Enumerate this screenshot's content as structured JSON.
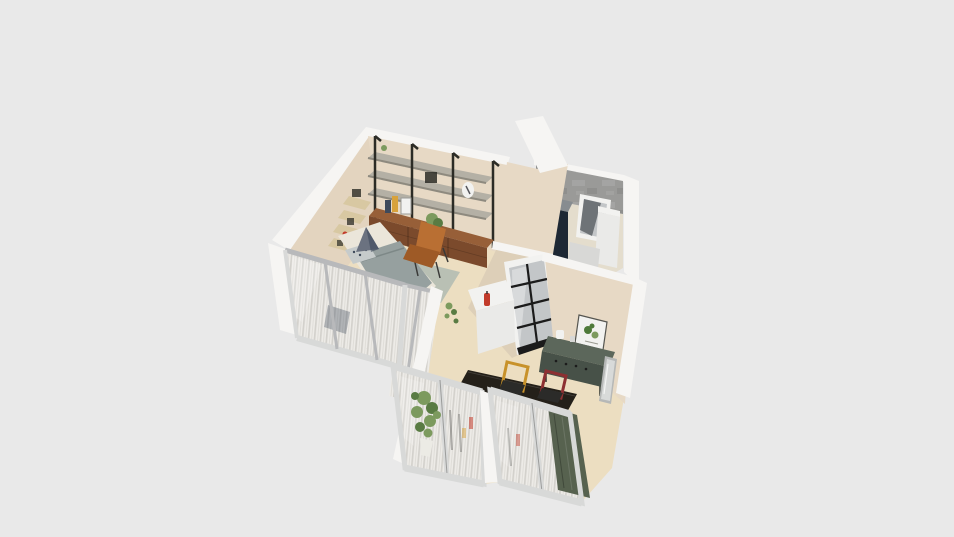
{
  "scene": {
    "type": "3d-floorplan-render",
    "view": "isometric-top-down",
    "visible_text": "",
    "rooms": [
      {
        "name": "bedroom",
        "items": [
          "bed",
          "gray-duvet",
          "triangle-headboard-cushion",
          "patterned-pillow",
          "corner-wall-shelves",
          "gray-green-rug",
          "glass-partition-sheer-curtains"
        ]
      },
      {
        "name": "living-area",
        "items": [
          "wall-shelving-unit-3-bays",
          "walnut-base-cabinets",
          "yellow-vase",
          "picture-frames",
          "potted-plants",
          "tan-leather-chair",
          "white-counter",
          "red-extinguisher",
          "floor-plant-sprig"
        ]
      },
      {
        "name": "kitchen",
        "items": [
          "concrete-accent-wall",
          "navy-refrigerator",
          "window",
          "white-tall-cabinet",
          "white-counter",
          "glazed-black-grid-door"
        ]
      },
      {
        "name": "dining-area",
        "items": [
          "dark-dining-table",
          "yellow-frame-chair",
          "red-frame-chair",
          "green-sideboard",
          "white-kettle",
          "botanical-wall-art",
          "leaning-floor-mirror"
        ]
      },
      {
        "name": "balcony-front",
        "items": [
          "sliding-glass-door-left",
          "sliding-glass-door-right",
          "sheer-curtains",
          "dark-green-curtain",
          "tall-potted-plant"
        ]
      }
    ]
  },
  "colors": {
    "background": "#e9e9e9",
    "wall_white": "#f6f5f3",
    "wall_beige": "#e7d9c5",
    "wall_beige2": "#e3d4bf",
    "wall_beige_shadow": "#ddcfb8",
    "floor": "#ecdec1",
    "floor_small": "#e4ddcd",
    "rug": "#b4bcb2",
    "concrete": "#9a9a98",
    "fridge": "#1e2834",
    "fridge_top": "#878c90",
    "cab_white": "#eaeae8",
    "cab_white_dark": "#d8d8d6",
    "glass_dark": "#5f6468",
    "glass_light": "#c3c6c8",
    "frame_white": "#f2f2f0",
    "muntin": "#1b1b1b",
    "pole": "#2c2c26",
    "shelf_gray": "#b4b0a5",
    "shelf_edge": "#8e8a7f",
    "wood_top": "#975f38",
    "wood_front": "#7b4a2c",
    "leather": "#b96f33",
    "leather_dark": "#9e5a26",
    "bed_cream": "#ebe6da",
    "duvet": "#96a09f",
    "pillow_navy": "#3e4a5b",
    "pillow_gray": "#c6cbcb",
    "headboard": "#6b7280",
    "corner_wood": "#d8c8a2",
    "sb_top": "#5c675b",
    "sb_front": "#475148",
    "table": "#242019",
    "chair_yellow": "#c8922a",
    "chair_red": "#8d3032",
    "seat": "#2b2b29",
    "curtain_base": "#edebe7",
    "curtain_stripe": "#d3d1cc",
    "curtain_green": "#57624f",
    "frame_light": "#d8d9d8",
    "frame_mid": "#b8b9bb",
    "plant": "#7c9a5e",
    "plant_dark": "#597b43",
    "pot": "#ecebe5",
    "red_item": "#c23b2a",
    "vase_yellow": "#d8a23c",
    "mirror_frame": "#b6b8b7",
    "mirror_glass": "#d8dad9",
    "art_green": "#4e7a3a"
  }
}
